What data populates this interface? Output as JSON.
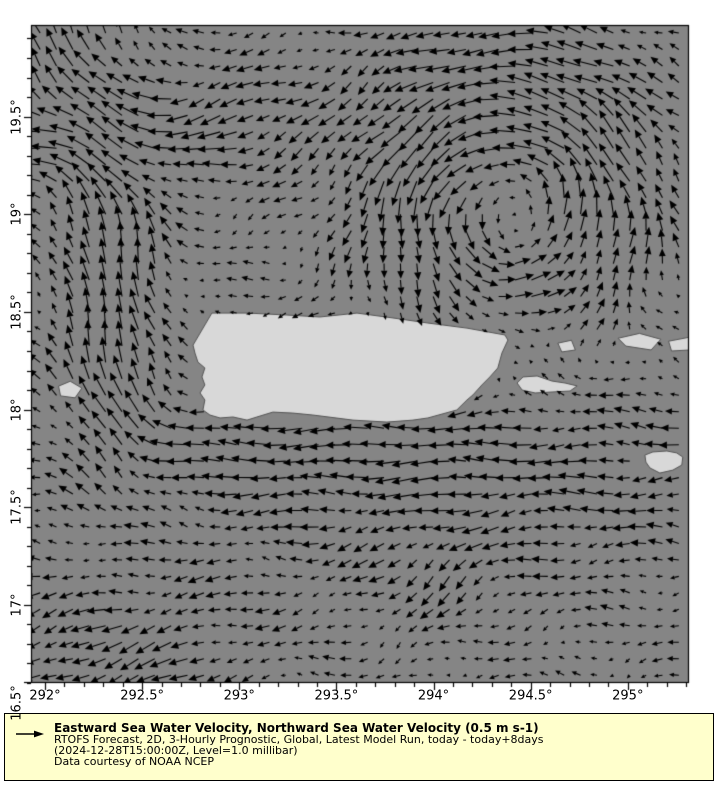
{
  "figure": {
    "width": 720,
    "height": 800,
    "background": "#ffffff"
  },
  "legend": {
    "background": "#ffffcc",
    "border_color": "#000000",
    "arrow_icon": "reference-vector-right-arrow",
    "title": "Eastward Sea Water Velocity, Northward Sea Water Velocity (0.5 m s-1)",
    "line1": "RTOFS Forecast, 2D, 3-Hourly Prognostic, Global, Latest Model Run, today - today+8days",
    "line2": "(2024-12-28T15:00:00Z, Level=1.0 millibar)",
    "line3": "Data courtesy of NOAA NCEP"
  },
  "chart_data": {
    "type": "quiver",
    "title": "Eastward Sea Water Velocity, Northward Sea Water Velocity (0.5 m s-1)",
    "reference_vector": {
      "value": 0.5,
      "units": "m s-1"
    },
    "xlim": [
      291.928,
      295.315
    ],
    "ylim": [
      16.6,
      19.969
    ],
    "x_ticks": [
      {
        "v": 292,
        "label": "292°"
      },
      {
        "v": 292.5,
        "label": "292.5°"
      },
      {
        "v": 293,
        "label": "293°"
      },
      {
        "v": 293.5,
        "label": "293.5°"
      },
      {
        "v": 294,
        "label": "294°"
      },
      {
        "v": 294.5,
        "label": "294.5°"
      },
      {
        "v": 295,
        "label": "295°"
      }
    ],
    "y_ticks": [
      {
        "v": 19.5,
        "label": "19.5°"
      },
      {
        "v": 19,
        "label": "19°"
      },
      {
        "v": 18.5,
        "label": "18.5°"
      },
      {
        "v": 18,
        "label": "18°"
      },
      {
        "v": 17.5,
        "label": "17.5°"
      },
      {
        "v": 17,
        "label": "17°"
      },
      {
        "v": 16.5,
        "label": "16.5°"
      }
    ],
    "minor_tick_step": 0.1,
    "plot_area": {
      "left": 31,
      "top": 25,
      "width": 658,
      "height": 658
    },
    "grid": {
      "lon_start": 291.975,
      "lat_start": 16.64,
      "step": 0.0843
    },
    "arrow": {
      "px_per_unit": 42,
      "max_px": 26,
      "min_px": 3.5,
      "color": "#000000"
    },
    "colors": {
      "sea": "#858585",
      "land": "#d8d8d8",
      "coast": "#555555",
      "frame": "#000000",
      "tick": "#000000"
    },
    "flow_model": {
      "background": {
        "u": -0.17,
        "v": 0
      },
      "noise_amp": 0.07,
      "features": [
        {
          "type": "vortex",
          "name": "atlantic-cyclonic-eddy",
          "lon": 294.4,
          "lat": 19.1,
          "strength": 0.5,
          "radius": 0.65,
          "ccw": true
        },
        {
          "type": "jet",
          "name": "mona-passage-northward-jet",
          "lon": 292.35,
          "lat": 18.55,
          "u": 0.06,
          "v": 0.8,
          "sx": 0.3,
          "sy": 0.85
        },
        {
          "type": "jet",
          "name": "northwest-westward-band",
          "lon": 292.25,
          "lat": 19.38,
          "u": -0.42,
          "v": -0.02,
          "sx": 0.6,
          "sy": 0.32
        },
        {
          "type": "jet",
          "name": "northwest-corner-northward-flow",
          "lon": 292.1,
          "lat": 19.95,
          "u": 0,
          "v": 0.5,
          "sx": 0.42,
          "sy": 0.4
        },
        {
          "type": "jet",
          "name": "north-central-southwest-patch",
          "lon": 293.0,
          "lat": 19.52,
          "u": -0.22,
          "v": -0.16,
          "sx": 0.45,
          "sy": 0.28
        },
        {
          "type": "jet",
          "name": "caribbean-westward-drift",
          "lon": 294.2,
          "lat": 17.7,
          "u": -0.3,
          "v": 0,
          "sx": 1.7,
          "sy": 0.55
        },
        {
          "type": "jet",
          "name": "southwest-corner-flow",
          "lon": 292.35,
          "lat": 16.72,
          "u": -0.28,
          "v": -0.2,
          "sx": 0.7,
          "sy": 0.4
        },
        {
          "type": "jet",
          "name": "central-caribbean-southward-dip",
          "lon": 294.0,
          "lat": 17.15,
          "u": 0,
          "v": -0.26,
          "sx": 0.45,
          "sy": 0.3
        },
        {
          "type": "jet",
          "name": "south-coast-westward-current",
          "lon": 293.4,
          "lat": 17.85,
          "u": -0.22,
          "v": 0,
          "sx": 1.1,
          "sy": 0.22
        }
      ]
    },
    "land_polygons": [
      {
        "name": "puerto-rico",
        "points": [
          [
            292.762,
            18.33
          ],
          [
            292.859,
            18.494
          ],
          [
            293.045,
            18.494
          ],
          [
            293.245,
            18.484
          ],
          [
            293.415,
            18.474
          ],
          [
            293.606,
            18.494
          ],
          [
            293.791,
            18.469
          ],
          [
            293.971,
            18.443
          ],
          [
            294.172,
            18.417
          ],
          [
            294.367,
            18.382
          ],
          [
            294.383,
            18.356
          ],
          [
            294.352,
            18.289
          ],
          [
            294.331,
            18.213
          ],
          [
            294.29,
            18.167
          ],
          [
            294.249,
            18.126
          ],
          [
            294.203,
            18.075
          ],
          [
            294.172,
            18.049
          ],
          [
            294.12,
            17.998
          ],
          [
            293.971,
            17.957
          ],
          [
            293.894,
            17.946
          ],
          [
            293.76,
            17.936
          ],
          [
            293.585,
            17.946
          ],
          [
            293.379,
            17.972
          ],
          [
            293.276,
            17.982
          ],
          [
            293.173,
            17.987
          ],
          [
            293.091,
            17.962
          ],
          [
            293.04,
            17.946
          ],
          [
            292.968,
            17.962
          ],
          [
            292.901,
            17.957
          ],
          [
            292.849,
            17.972
          ],
          [
            292.813,
            17.998
          ],
          [
            292.823,
            18.049
          ],
          [
            292.798,
            18.085
          ],
          [
            292.823,
            18.126
          ],
          [
            292.808,
            18.167
          ],
          [
            292.823,
            18.213
          ],
          [
            292.787,
            18.243
          ],
          [
            292.772,
            18.289
          ]
        ]
      },
      {
        "name": "vieques",
        "points": [
          [
            294.43,
            18.136
          ],
          [
            294.461,
            18.167
          ],
          [
            294.533,
            18.172
          ],
          [
            294.61,
            18.146
          ],
          [
            294.677,
            18.136
          ],
          [
            294.739,
            18.121
          ],
          [
            294.703,
            18.095
          ],
          [
            294.61,
            18.09
          ],
          [
            294.523,
            18.085
          ],
          [
            294.456,
            18.1
          ]
        ]
      },
      {
        "name": "culebra",
        "points": [
          [
            294.64,
            18.34
          ],
          [
            294.71,
            18.355
          ],
          [
            294.73,
            18.305
          ],
          [
            294.66,
            18.295
          ]
        ]
      },
      {
        "name": "st-thomas",
        "points": [
          [
            294.95,
            18.365
          ],
          [
            295.06,
            18.39
          ],
          [
            295.17,
            18.36
          ],
          [
            295.12,
            18.305
          ],
          [
            294.99,
            18.325
          ]
        ]
      },
      {
        "name": "st-john-tortola",
        "points": [
          [
            295.21,
            18.35
          ],
          [
            295.315,
            18.37
          ],
          [
            295.32,
            18.305
          ],
          [
            295.225,
            18.3
          ]
        ]
      },
      {
        "name": "st-croix",
        "points": [
          [
            295.088,
            17.767
          ],
          [
            295.129,
            17.783
          ],
          [
            295.201,
            17.788
          ],
          [
            295.252,
            17.778
          ],
          [
            295.283,
            17.757
          ],
          [
            295.278,
            17.716
          ],
          [
            295.232,
            17.69
          ],
          [
            295.165,
            17.675
          ],
          [
            295.114,
            17.701
          ],
          [
            295.093,
            17.731
          ]
        ]
      },
      {
        "name": "mona-island",
        "points": [
          [
            292.07,
            18.12
          ],
          [
            292.13,
            18.145
          ],
          [
            292.19,
            18.11
          ],
          [
            292.155,
            18.06
          ],
          [
            292.08,
            18.07
          ]
        ]
      }
    ]
  }
}
